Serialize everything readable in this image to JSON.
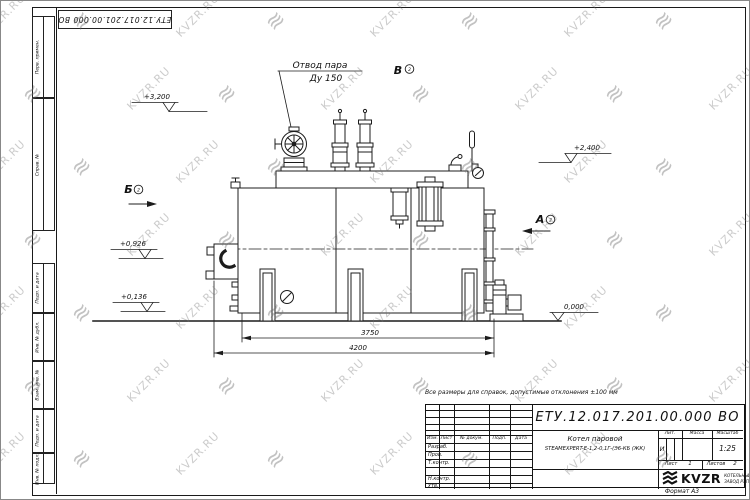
{
  "watermark": {
    "text": "KVZR.RU",
    "logo_glyph": "≋"
  },
  "frame": {
    "top_stamp": "ЕТУ.12.017.201.00.000 ВО",
    "side_boxes_top": [
      {
        "label": "Перв. примен."
      },
      {
        "label": "Справ. №"
      }
    ],
    "side_boxes_bottom": [
      {
        "label": "Подп. и дата"
      },
      {
        "label": "Инв. № дубл."
      },
      {
        "label": "Взам. инв. №"
      },
      {
        "label": "Подп. и дата"
      },
      {
        "label": "Инв. № подл."
      }
    ],
    "format_label": "Формат А3"
  },
  "note": "Все размеры для справок, допустимые отклонения ±100 мм",
  "drawing": {
    "steam_outlet_label": {
      "line1": "Отвод пара",
      "line2": "Ду 150"
    },
    "views": {
      "a": "А",
      "b": "Б",
      "v": "В",
      "sheet_ref": "2"
    },
    "elevations": [
      "+3,200",
      "+2,400",
      "+0,926",
      "+0,136",
      "0,000"
    ],
    "dimensions": [
      "3750",
      "4200"
    ]
  },
  "title_block": {
    "designation": "ЕТУ.12.017.201.00.000 ВО",
    "product_name_line1": "Котел паровой",
    "product_name_line2": "STEAMEXPERT-Е-1,2-0,1Г-(Э6-КБ (ЖК)",
    "change_header": {
      "izm": "Изм.",
      "list": "Лист",
      "doc": "№ докум.",
      "sign": "Подп.",
      "date": "Дата"
    },
    "staff_rows": [
      {
        "label": "Разраб."
      },
      {
        "label": "Пров."
      },
      {
        "label": "Т.контр."
      },
      {
        "label": ""
      },
      {
        "label": "Н.контр."
      },
      {
        "label": "Утв."
      }
    ],
    "lit_label": "Лит.",
    "lit_value": "И",
    "mass_label": "Масса",
    "scale_label": "Масштаб",
    "scale_value": "1:25",
    "sheet_label": "Лист",
    "sheet_value": "1",
    "sheets_label": "Листов",
    "sheets_value": "2",
    "company": {
      "name": "KVZR",
      "tagline1": "КОТЕЛЬНЫЙ",
      "tagline2": "ЗАВОД РЭП"
    }
  }
}
